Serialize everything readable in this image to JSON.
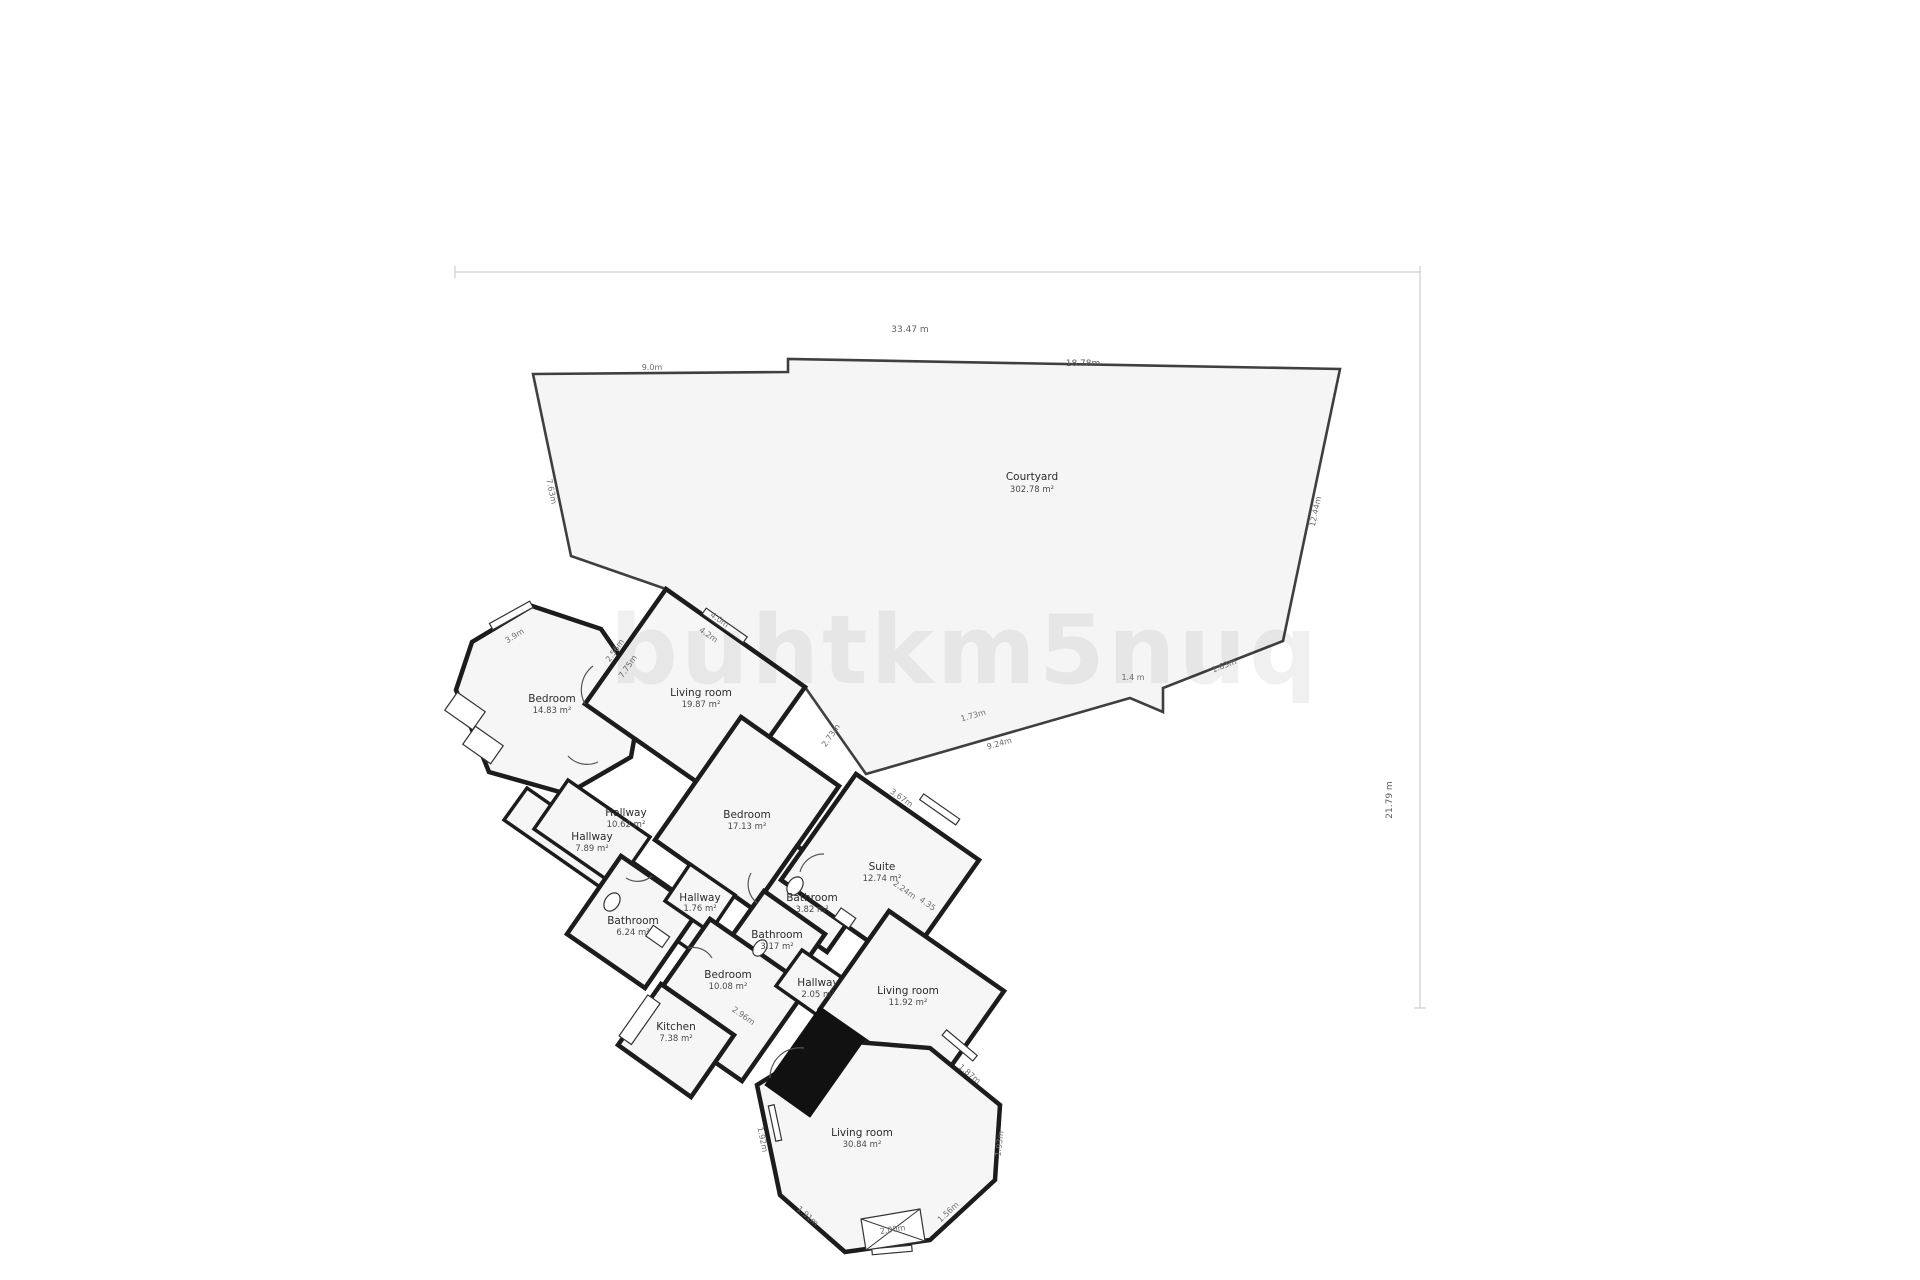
{
  "watermark": {
    "text": "buhtkm5nuq"
  },
  "rooms": [
    {
      "id": "bedroom-a",
      "name": "Bedroom",
      "area": "14.83 m²"
    },
    {
      "id": "living-room-a",
      "name": "Living room",
      "area": "19.87 m²"
    },
    {
      "id": "hallway-a",
      "name": "Hallway",
      "area": "7.89 m²"
    },
    {
      "id": "hallway-b",
      "name": "Hallway",
      "area": "10.62 m²"
    },
    {
      "id": "bedroom-b",
      "name": "Bedroom",
      "area": "17.13 m²"
    },
    {
      "id": "bathroom-a",
      "name": "Bathroom",
      "area": "6.24 m²"
    },
    {
      "id": "hallway-c",
      "name": "Hallway",
      "area": "1.76 m²"
    },
    {
      "id": "bathroom-b",
      "name": "Bathroom",
      "area": "3.82 m²"
    },
    {
      "id": "bathroom-c",
      "name": "Bathroom",
      "area": "3.17 m²"
    },
    {
      "id": "suite",
      "name": "Suite",
      "area": "12.74 m²"
    },
    {
      "id": "bedroom-c",
      "name": "Bedroom",
      "area": "10.08 m²"
    },
    {
      "id": "hallway-e",
      "name": "Hallway",
      "area": "2.05 m²"
    },
    {
      "id": "living-room-b",
      "name": "Living room",
      "area": "11.92 m²"
    },
    {
      "id": "kitchen",
      "name": "Kitchen",
      "area": "7.38 m²"
    },
    {
      "id": "living-room-c",
      "name": "Living room",
      "area": "30.84 m²"
    },
    {
      "id": "courtyard",
      "name": "Courtyard",
      "area": "302.78 m²"
    }
  ],
  "dimensions": [
    {
      "text": "33.47 m"
    },
    {
      "text": "18.78m"
    },
    {
      "text": "9.0m"
    },
    {
      "text": "7.63m"
    },
    {
      "text": "12.44m"
    },
    {
      "text": "1.4 m"
    },
    {
      "text": "1.63m"
    },
    {
      "text": "1.73m"
    },
    {
      "text": "9.24m"
    },
    {
      "text": "21.79 m"
    },
    {
      "text": "3.9m"
    },
    {
      "text": "2.56m"
    },
    {
      "text": "7.75m"
    },
    {
      "text": "4.0m"
    },
    {
      "text": "4.2m"
    },
    {
      "text": "2.73m"
    },
    {
      "text": "3.67m"
    },
    {
      "text": "2.24m"
    },
    {
      "text": "4.35"
    },
    {
      "text": "2.96m"
    },
    {
      "text": "1.91m"
    },
    {
      "text": "1.56m"
    },
    {
      "text": "1.87m"
    },
    {
      "text": "1.93m"
    },
    {
      "text": "2.00m"
    },
    {
      "text": "1.92m"
    }
  ],
  "colors": {
    "wall": "#1c1c1c",
    "room_fill": "#f6f6f6",
    "courtyard_outline": "#3f3f3f",
    "dimension_text": "#6d6d6d",
    "watermark_tint": "#ebebeb"
  }
}
